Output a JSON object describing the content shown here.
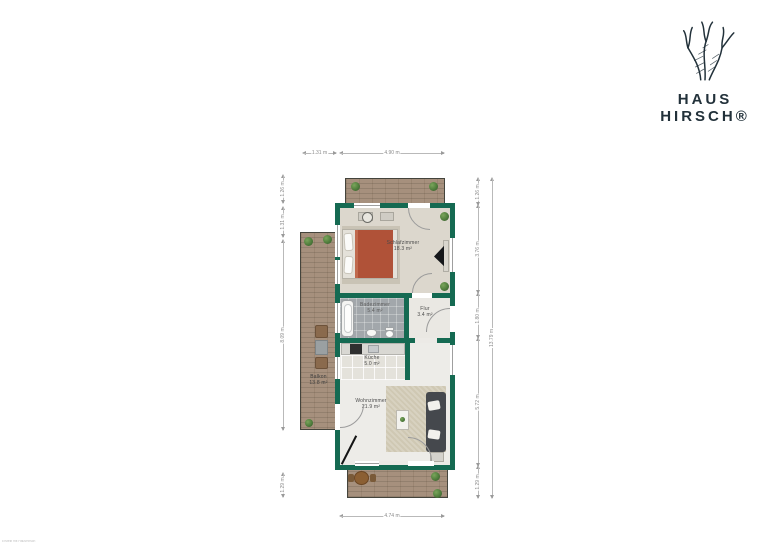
{
  "brand": {
    "line1": "HAUS",
    "line2": "HIRSCH®"
  },
  "rooms": [
    {
      "name": "Schlafzimmer",
      "area": "18.3 m²"
    },
    {
      "name": "Badezimmer",
      "area": "5.4 m²"
    },
    {
      "name": "Flur",
      "area": "3.4 m²"
    },
    {
      "name": "Küche",
      "area": "5.0 m²"
    },
    {
      "name": "Wohnzimmer",
      "area": "21.9 m²"
    },
    {
      "name": "Balkon",
      "area": "13.8 m²"
    }
  ],
  "dimensions": {
    "top": [
      "1.31 m",
      "4.90 m"
    ],
    "bottom": [
      "4.74 m"
    ],
    "left": [
      "1.26 m",
      "1.31 m",
      "8.09 m",
      "1.29 m"
    ],
    "right": [
      "1.26 m",
      "3.76 m",
      "1.80 m",
      "5.72 m",
      "1.29 m"
    ],
    "right_total": "13.79 m"
  },
  "watermark": "Erstellt mit HausHirsch",
  "colors": {
    "wall": "#156a52",
    "logo": "#22313a",
    "plant": "#4f7d3c",
    "bed": "#b05238",
    "rug": "#cfc8b3",
    "sofa": "#45484d",
    "deck": "#a6907d"
  }
}
